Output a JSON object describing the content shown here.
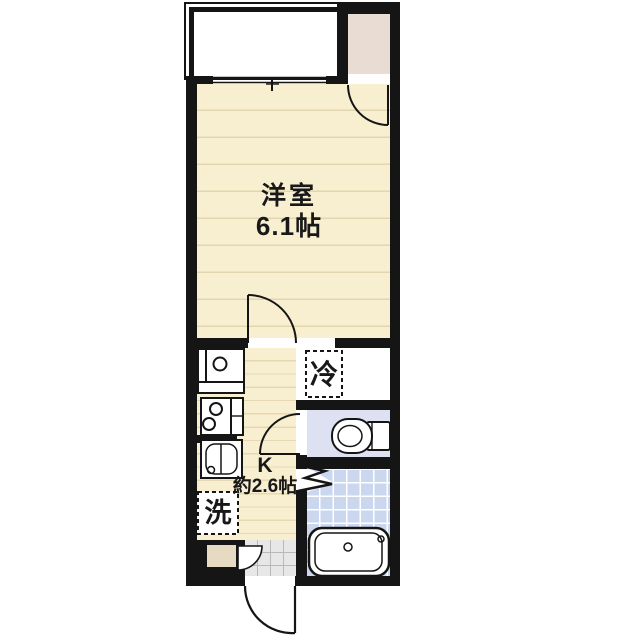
{
  "floorplan": {
    "type": "japanese-apartment-1K",
    "rooms": {
      "western_room": {
        "name": "洋室",
        "size": "6.1帖"
      },
      "kitchen": {
        "name": "K",
        "size": "約2.6帖"
      },
      "refrigerator_space": {
        "label": "冷"
      },
      "washer_space": {
        "label": "洗"
      }
    },
    "fixtures": [
      "balcony-window",
      "closet",
      "sink",
      "stove",
      "washbasin",
      "toilet",
      "bathtub",
      "entry-door",
      "shoe-cabinet"
    ],
    "colors": {
      "wall": "#151515",
      "room_floor": "#f8efd0",
      "floor_line": "#e3d5ae",
      "closet": "#e9ddd3",
      "toilet_floor": "#dde1f2",
      "bath_tile": "#cad7ef",
      "entrance_tile": "#e7e7e7",
      "shoe_cabinet": "#e7dac2"
    }
  }
}
